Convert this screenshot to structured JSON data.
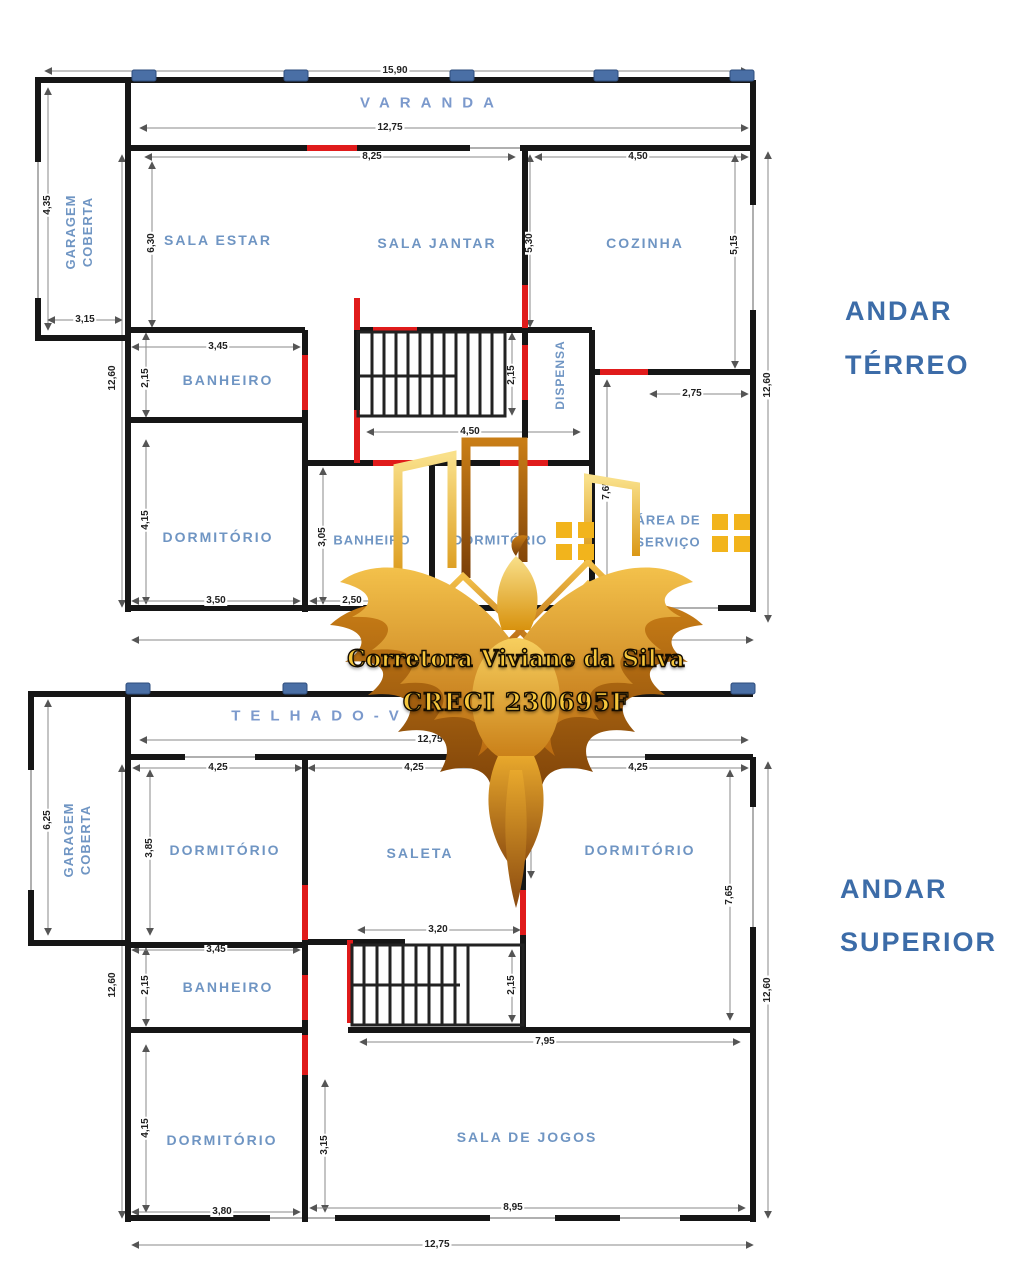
{
  "watermark": {
    "line1": "Corretora Viviane da Silva",
    "line2": "CRECI 230695F"
  },
  "ground": {
    "title1": "ANDAR",
    "title2": "TÉRREO",
    "varanda": "VARANDA",
    "garagem1": "GARAGEM",
    "garagem2": "COBERTA",
    "sala_estar": "SALA  ESTAR",
    "sala_jantar": "SALA  JANTAR",
    "cozinha": "COZINHA",
    "banheiro1": "BANHEIRO",
    "dispensa": "DISPENSA",
    "dormitorio1": "DORMITÓRIO",
    "banheiro2": "BANHEIRO",
    "dormitorio2": "DORMITÓRIO",
    "area1": "ÁREA DE",
    "area2": "SERVIÇO",
    "d_total_top": "15,90",
    "d_varanda": "12,75",
    "d_salas_top": "8,25",
    "d_cozinha_top": "4,50",
    "d_gar_h": "4,35",
    "d_gar_w": "3,15",
    "d_left": "12,60",
    "d_estar_h": "6,30",
    "d_ban1_w": "3,45",
    "d_ban1_h": "2,15",
    "d_jantar_h": "5,30",
    "d_coz_h": "5,15",
    "d_stairs_h": "2,15",
    "d_hall": "4,50",
    "d_serv_w": "2,75",
    "d_serv_h": "7,65",
    "d_right": "12,60",
    "d_dorm1_h": "4,15",
    "d_dorm1_w": "3,50",
    "d_ban2_h": "3,05",
    "d_ban2_w": "2,50"
  },
  "upper": {
    "title1": "ANDAR",
    "title2": "SUPERIOR",
    "telhado": "TELHADO-V",
    "garagem1": "GARAGEM",
    "garagem2": "COBERTA",
    "dormitorio1": "DORMITÓRIO",
    "saleta": "SALETA",
    "dormitorio2": "DORMITÓRIO",
    "banheiro": "BANHEIRO",
    "dormitorio3": "DORMITÓRIO",
    "sala_jogos": "SALA DE JOGOS",
    "d_top": "12,75",
    "d_gar_h": "6,25",
    "d_left": "12,60",
    "d_dorm1_w": "4,25",
    "d_saleta_w": "4,25",
    "d_dorm2_w": "4,25",
    "d_dorm1_h": "3,85",
    "d_saleta_door": "5,30",
    "d_dorm2_h": "7,65",
    "d_right": "12,60",
    "d_stairs_w": "3,20",
    "d_stairs_h": "2,15",
    "d_ban_w": "3,45",
    "d_ban_h": "2,15",
    "d_hall": "7,95",
    "d_dorm3_h": "4,15",
    "d_dorm3_w": "3,80",
    "d_jogos_door": "3,15",
    "d_jogos_w": "8,95",
    "d_bottom": "12,75"
  },
  "colors": {
    "wall": "#161616",
    "door": "#e01b1b",
    "room_label": "#6f95c3",
    "title": "#3c6ca8",
    "dim_line": "#8a8a8a",
    "column": "#4a6fa5",
    "gold": "#e8a20c"
  }
}
